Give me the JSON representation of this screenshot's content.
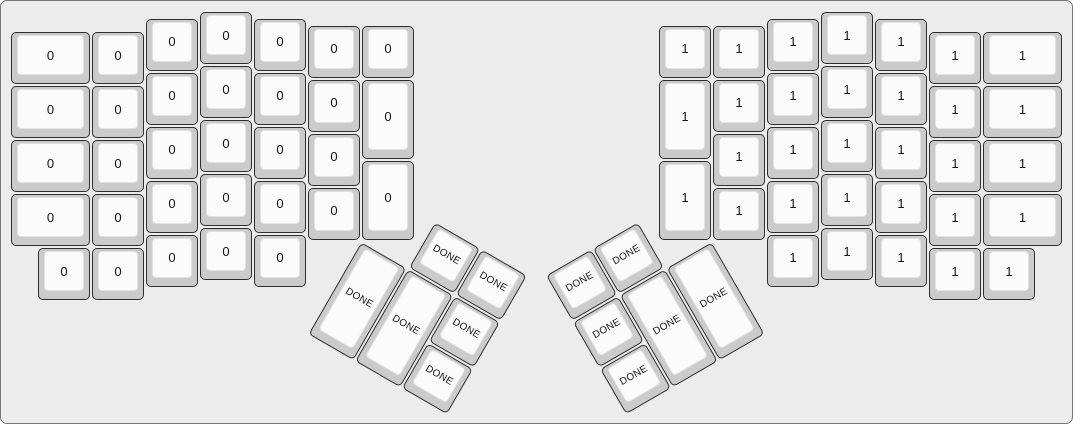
{
  "canvas": {
    "width_px": 1073,
    "height_px": 424,
    "background_color": "#ececec",
    "border_color": "#777777"
  },
  "key_style": {
    "unit_px": 54,
    "origin_px": {
      "x": 9,
      "y": 10
    },
    "side_color": "#cbcbcb",
    "top_color": "#fbfbfb",
    "outline_color": "#2f2f2f",
    "label_color": "#141414"
  },
  "keyboard": {
    "groups": [
      {
        "name": "left-main",
        "r": 0,
        "rx": 0,
        "ry": 0,
        "keys": [
          {
            "x": 0,
            "y": 0.375,
            "w": 1.5,
            "h": 1,
            "label": "0"
          },
          {
            "x": 1.5,
            "y": 0.375,
            "w": 1,
            "h": 1,
            "label": "0"
          },
          {
            "x": 2.5,
            "y": 0.125,
            "w": 1,
            "h": 1,
            "label": "0"
          },
          {
            "x": 3.5,
            "y": 0,
            "w": 1,
            "h": 1,
            "label": "0"
          },
          {
            "x": 4.5,
            "y": 0.125,
            "w": 1,
            "h": 1,
            "label": "0"
          },
          {
            "x": 5.5,
            "y": 0.25,
            "w": 1,
            "h": 1,
            "label": "0"
          },
          {
            "x": 6.5,
            "y": 0.25,
            "w": 1,
            "h": 1,
            "label": "0"
          },
          {
            "x": 0,
            "y": 1.375,
            "w": 1.5,
            "h": 1,
            "label": "0"
          },
          {
            "x": 1.5,
            "y": 1.375,
            "w": 1,
            "h": 1,
            "label": "0"
          },
          {
            "x": 2.5,
            "y": 1.125,
            "w": 1,
            "h": 1,
            "label": "0"
          },
          {
            "x": 3.5,
            "y": 1,
            "w": 1,
            "h": 1,
            "label": "0"
          },
          {
            "x": 4.5,
            "y": 1.125,
            "w": 1,
            "h": 1,
            "label": "0"
          },
          {
            "x": 5.5,
            "y": 1.25,
            "w": 1,
            "h": 1,
            "label": "0"
          },
          {
            "x": 6.5,
            "y": 1.25,
            "w": 1,
            "h": 1.5,
            "label": "0"
          },
          {
            "x": 0,
            "y": 2.375,
            "w": 1.5,
            "h": 1,
            "label": "0"
          },
          {
            "x": 1.5,
            "y": 2.375,
            "w": 1,
            "h": 1,
            "label": "0"
          },
          {
            "x": 2.5,
            "y": 2.125,
            "w": 1,
            "h": 1,
            "label": "0"
          },
          {
            "x": 3.5,
            "y": 2,
            "w": 1,
            "h": 1,
            "label": "0"
          },
          {
            "x": 4.5,
            "y": 2.125,
            "w": 1,
            "h": 1,
            "label": "0"
          },
          {
            "x": 5.5,
            "y": 2.25,
            "w": 1,
            "h": 1,
            "label": "0"
          },
          {
            "x": 6.5,
            "y": 2.75,
            "w": 1,
            "h": 1.5,
            "label": "0"
          },
          {
            "x": 0,
            "y": 3.375,
            "w": 1.5,
            "h": 1,
            "label": "0"
          },
          {
            "x": 1.5,
            "y": 3.375,
            "w": 1,
            "h": 1,
            "label": "0"
          },
          {
            "x": 2.5,
            "y": 3.125,
            "w": 1,
            "h": 1,
            "label": "0"
          },
          {
            "x": 3.5,
            "y": 3,
            "w": 1,
            "h": 1,
            "label": "0"
          },
          {
            "x": 4.5,
            "y": 3.125,
            "w": 1,
            "h": 1,
            "label": "0"
          },
          {
            "x": 5.5,
            "y": 3.25,
            "w": 1,
            "h": 1,
            "label": "0"
          },
          {
            "x": 0.5,
            "y": 4.375,
            "w": 1,
            "h": 1,
            "label": "0"
          },
          {
            "x": 1.5,
            "y": 4.375,
            "w": 1,
            "h": 1,
            "label": "0"
          },
          {
            "x": 2.5,
            "y": 4.125,
            "w": 1,
            "h": 1,
            "label": "0"
          },
          {
            "x": 3.5,
            "y": 4,
            "w": 1,
            "h": 1,
            "label": "0"
          },
          {
            "x": 4.5,
            "y": 4.125,
            "w": 1,
            "h": 1,
            "label": "0"
          }
        ]
      },
      {
        "name": "right-main",
        "r": 0,
        "rx": 0,
        "ry": 0,
        "keys": [
          {
            "x": 12,
            "y": 0.25,
            "w": 1,
            "h": 1,
            "label": "1"
          },
          {
            "x": 13,
            "y": 0.25,
            "w": 1,
            "h": 1,
            "label": "1"
          },
          {
            "x": 14,
            "y": 0.125,
            "w": 1,
            "h": 1,
            "label": "1"
          },
          {
            "x": 15,
            "y": 0,
            "w": 1,
            "h": 1,
            "label": "1"
          },
          {
            "x": 16,
            "y": 0.125,
            "w": 1,
            "h": 1,
            "label": "1"
          },
          {
            "x": 17,
            "y": 0.375,
            "w": 1,
            "h": 1,
            "label": "1"
          },
          {
            "x": 18,
            "y": 0.375,
            "w": 1.5,
            "h": 1,
            "label": "1"
          },
          {
            "x": 12,
            "y": 1.25,
            "w": 1,
            "h": 1.5,
            "label": "1"
          },
          {
            "x": 13,
            "y": 1.25,
            "w": 1,
            "h": 1,
            "label": "1"
          },
          {
            "x": 14,
            "y": 1.125,
            "w": 1,
            "h": 1,
            "label": "1"
          },
          {
            "x": 15,
            "y": 1,
            "w": 1,
            "h": 1,
            "label": "1"
          },
          {
            "x": 16,
            "y": 1.125,
            "w": 1,
            "h": 1,
            "label": "1"
          },
          {
            "x": 17,
            "y": 1.375,
            "w": 1,
            "h": 1,
            "label": "1"
          },
          {
            "x": 18,
            "y": 1.375,
            "w": 1.5,
            "h": 1,
            "label": "1"
          },
          {
            "x": 12,
            "y": 2.75,
            "w": 1,
            "h": 1.5,
            "label": "1"
          },
          {
            "x": 13,
            "y": 2.25,
            "w": 1,
            "h": 1,
            "label": "1"
          },
          {
            "x": 14,
            "y": 2.125,
            "w": 1,
            "h": 1,
            "label": "1"
          },
          {
            "x": 15,
            "y": 2,
            "w": 1,
            "h": 1,
            "label": "1"
          },
          {
            "x": 16,
            "y": 2.125,
            "w": 1,
            "h": 1,
            "label": "1"
          },
          {
            "x": 17,
            "y": 2.375,
            "w": 1,
            "h": 1,
            "label": "1"
          },
          {
            "x": 18,
            "y": 2.375,
            "w": 1.5,
            "h": 1,
            "label": "1"
          },
          {
            "x": 13,
            "y": 3.25,
            "w": 1,
            "h": 1,
            "label": "1"
          },
          {
            "x": 14,
            "y": 3.125,
            "w": 1,
            "h": 1,
            "label": "1"
          },
          {
            "x": 15,
            "y": 3,
            "w": 1,
            "h": 1,
            "label": "1"
          },
          {
            "x": 16,
            "y": 3.125,
            "w": 1,
            "h": 1,
            "label": "1"
          },
          {
            "x": 17,
            "y": 3.375,
            "w": 1,
            "h": 1,
            "label": "1"
          },
          {
            "x": 18,
            "y": 3.375,
            "w": 1.5,
            "h": 1,
            "label": "1"
          },
          {
            "x": 14,
            "y": 4.125,
            "w": 1,
            "h": 1,
            "label": "1"
          },
          {
            "x": 15,
            "y": 4,
            "w": 1,
            "h": 1,
            "label": "1"
          },
          {
            "x": 16,
            "y": 4.125,
            "w": 1,
            "h": 1,
            "label": "1"
          },
          {
            "x": 17,
            "y": 4.375,
            "w": 1,
            "h": 1,
            "label": "1"
          },
          {
            "x": 18,
            "y": 4.375,
            "w": 1,
            "h": 1,
            "label": "1"
          }
        ]
      },
      {
        "name": "left-thumb",
        "r": 30,
        "rx": 6.5,
        "ry": 4.25,
        "keys": [
          {
            "x": 1,
            "y": -1,
            "w": 1,
            "h": 1,
            "label": "DONE"
          },
          {
            "x": 2,
            "y": -1,
            "w": 1,
            "h": 1,
            "label": "DONE"
          },
          {
            "x": 0,
            "y": 0,
            "w": 1,
            "h": 2,
            "label": "DONE"
          },
          {
            "x": 1,
            "y": 0,
            "w": 1,
            "h": 2,
            "label": "DONE"
          },
          {
            "x": 2,
            "y": 0,
            "w": 1,
            "h": 1,
            "label": "DONE"
          },
          {
            "x": 2,
            "y": 1,
            "w": 1,
            "h": 1,
            "label": "DONE"
          }
        ]
      },
      {
        "name": "right-thumb",
        "r": -30,
        "rx": 13,
        "ry": 4.25,
        "keys": [
          {
            "x": -3,
            "y": -1,
            "w": 1,
            "h": 1,
            "label": "DONE"
          },
          {
            "x": -2,
            "y": -1,
            "w": 1,
            "h": 1,
            "label": "DONE"
          },
          {
            "x": -3,
            "y": 0,
            "w": 1,
            "h": 1,
            "label": "DONE"
          },
          {
            "x": -2,
            "y": 0,
            "w": 1,
            "h": 2,
            "label": "DONE"
          },
          {
            "x": -1,
            "y": 0,
            "w": 1,
            "h": 2,
            "label": "DONE"
          },
          {
            "x": -3,
            "y": 1,
            "w": 1,
            "h": 1,
            "label": "DONE"
          }
        ]
      }
    ]
  }
}
